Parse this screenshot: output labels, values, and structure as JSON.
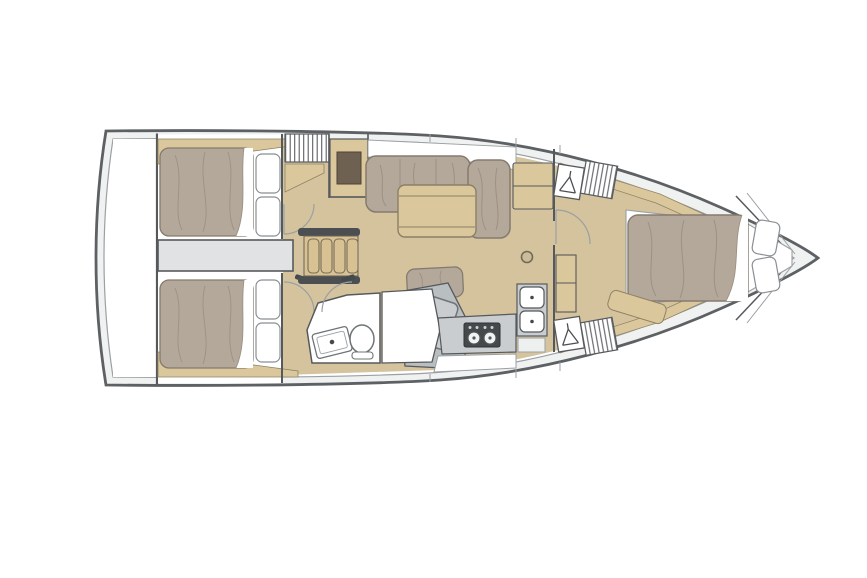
{
  "page": {
    "background": "#ffffff",
    "description": "Top-down interior layout plan of a sailing yacht, bow pointing right, no visible text"
  },
  "colors": {
    "hullStroke": "#5d6164",
    "wallStroke": "#56595c",
    "deckBand": "#f0f1f1",
    "interiorWhite": "#ffffff",
    "floorWood": "#d5c39d",
    "woodTrim": "#dbc79c",
    "woodStep": "#d8c294",
    "mattress": "#b4a89b",
    "mattressShade": "#9d9184",
    "grayZone": "#e0e2e4",
    "grayMid": "#c9cdcf",
    "grayNav": "#b9bec1",
    "grayDark": "#45494c",
    "insetBrown": "#6f6152",
    "lineLight": "#9aa0a4"
  },
  "plan": {
    "vessel_type": "sailing-yacht-monohull",
    "orientation": "bow-right",
    "cabins": [
      {
        "id": "aft-cabin-port",
        "label": "Aft cabin (port)",
        "features": [
          "double-berth",
          "two-pillows",
          "door-swing-arc",
          "hull-side-wood-trim"
        ]
      },
      {
        "id": "aft-cabin-starboard",
        "label": "Aft cabin (starboard)",
        "features": [
          "double-berth",
          "two-pillows",
          "door-swing-arc",
          "hull-side-wood-trim"
        ]
      },
      {
        "id": "forward-cabin",
        "label": "Forward owner cabin",
        "features": [
          "island-double-berth",
          "two-pillows",
          "hanging-lockers",
          "louvered-lockers",
          "seat-bench",
          "cabinet",
          "door-swing-arc"
        ]
      }
    ],
    "saloon": {
      "features": [
        "l-shaped-settee",
        "corner-chaise-cushion",
        "folding-leaf-table",
        "bench-seat-cushion",
        "sideboard",
        "table-pedestal-mount",
        "storage-cabinet-with-inset",
        "louvered-locker"
      ]
    },
    "galley": {
      "features": [
        "two-burner-stove",
        "double-round-sink",
        "worktop",
        "lower-counter"
      ]
    },
    "head": {
      "features": [
        "marine-toilet",
        "tilted-washbasin",
        "separate-shower-stall"
      ]
    },
    "nav_station": {
      "features": [
        "tilted-chart-table",
        "gray-sole"
      ]
    },
    "other": [
      "companionway-steps-with-handrails",
      "engine-compartment-strip",
      "transom-platform",
      "bow-anchor-locker-v",
      "door-swing-arcs",
      "deck-side-band"
    ]
  }
}
